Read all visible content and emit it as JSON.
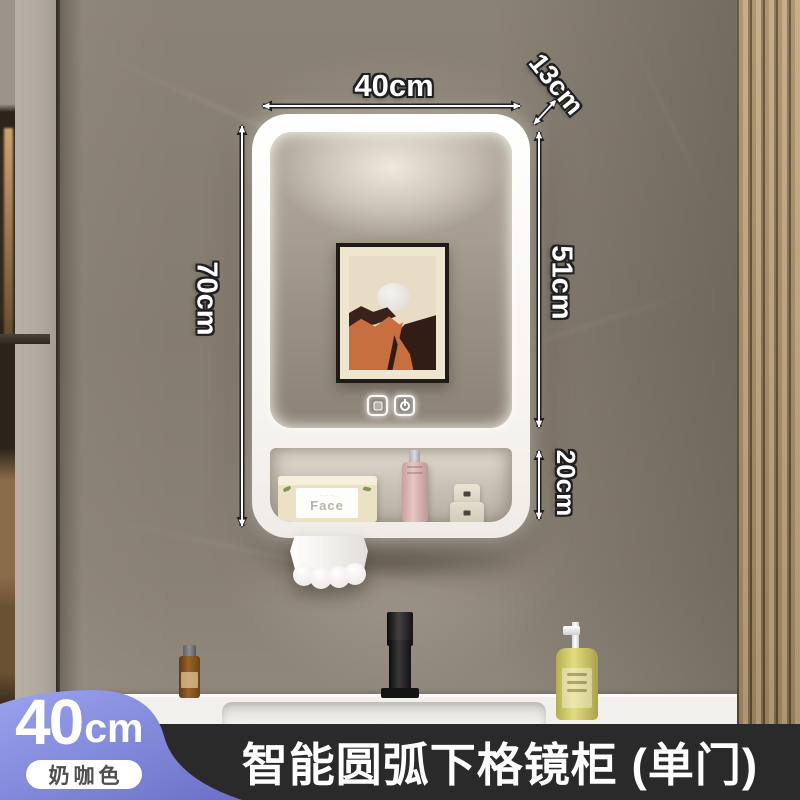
{
  "product": {
    "title": "智能圆弧下格镜柜 (单门)"
  },
  "annotations": {
    "width_label": "40cm",
    "depth_label": "13cm",
    "height_label": "70cm",
    "mirror_height_label": "51cm",
    "shelf_height_label": "20cm"
  },
  "badge": {
    "size_number": "40",
    "size_unit": "cm",
    "color_name": "奶咖色"
  },
  "cabinet": {
    "tissue_box_label": "Face",
    "touch_buttons": [
      "screen-icon",
      "power-icon"
    ],
    "shelf_items": [
      "tissue-box",
      "pink-lotion-bottle",
      "cosmetic-jar-small",
      "cosmetic-jar-large"
    ]
  },
  "colors": {
    "badge_accent_top": "#9aa3ee",
    "badge_accent_bottom": "#6b70c6",
    "banner_background": "#2a2a2a",
    "led_glow": "#ffffff",
    "art_orange": "#c76f3e",
    "wall_marble": "#877e72"
  }
}
